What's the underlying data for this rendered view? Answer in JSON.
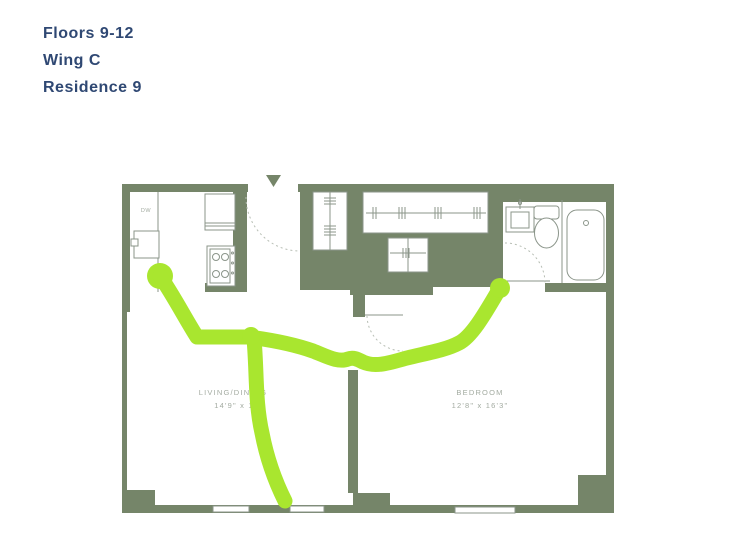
{
  "header": {
    "lines": [
      "Floors 9-12",
      "Wing C",
      "Residence 9"
    ]
  },
  "floorplan": {
    "rooms": {
      "living": {
        "name": "LIVING/DINING",
        "dims": "14'9\" x 13'"
      },
      "bedroom": {
        "name": "BEDROOM",
        "dims": "12'8\" x 16'3\""
      }
    },
    "kitchen": {
      "dishwasher_label": "DW"
    },
    "colors": {
      "wall": "#758569",
      "fixture_line": "#8b958a",
      "door_swing_dash": "#b7beb4",
      "room_label": "#a3aba1",
      "highlight_route": "#a9e62f",
      "title_text": "#2f4873"
    }
  }
}
